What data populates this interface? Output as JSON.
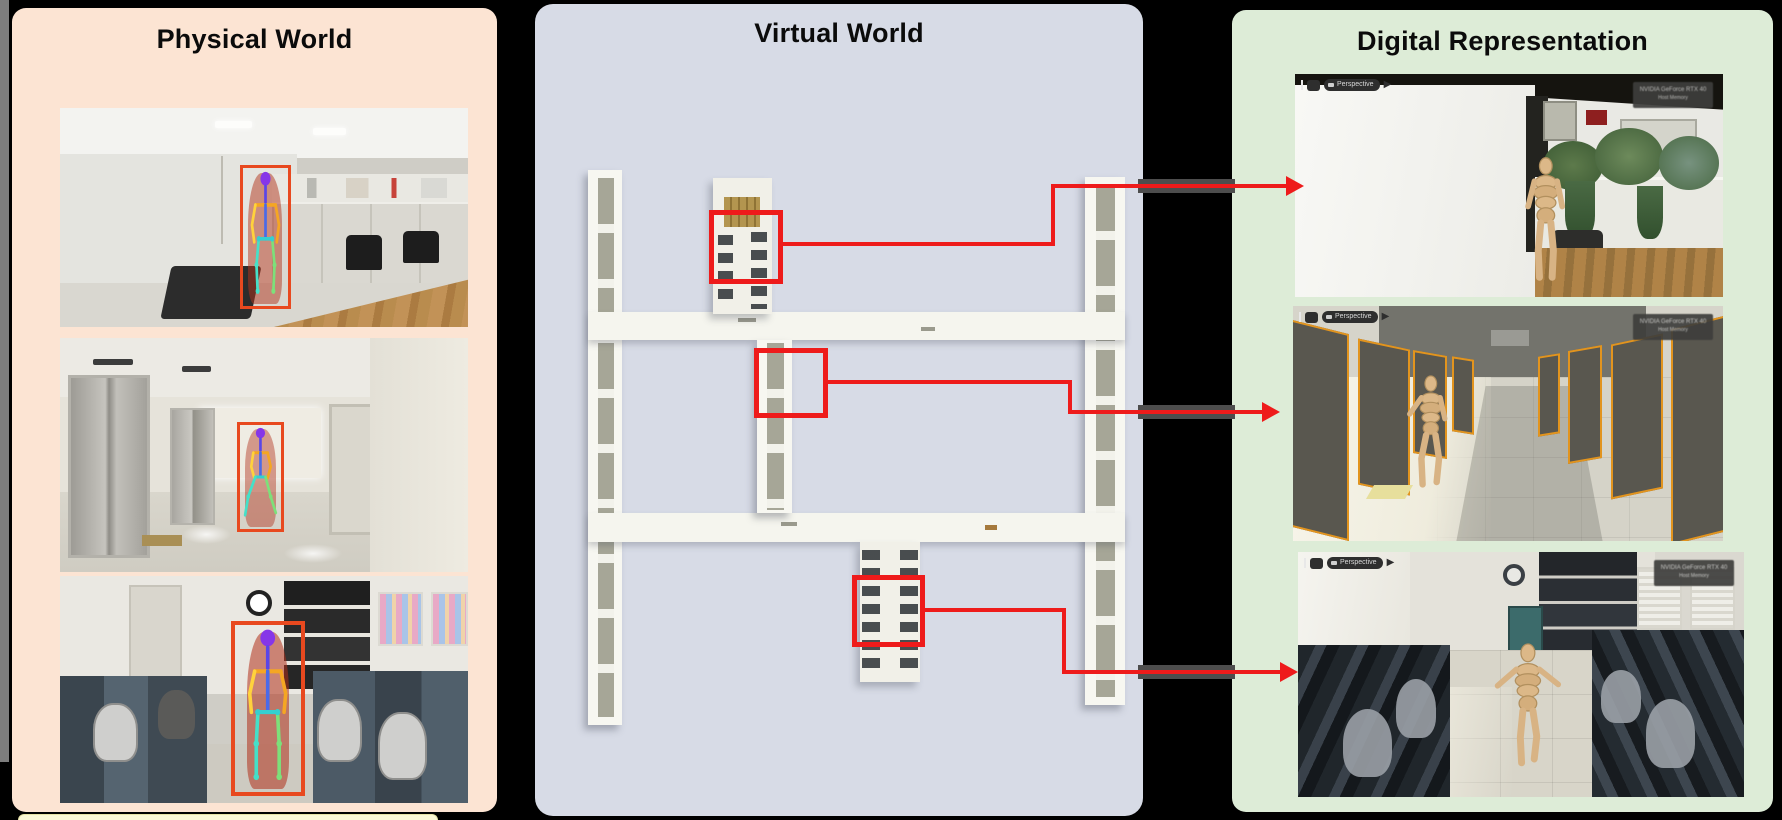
{
  "panels": {
    "physical": {
      "title": "Physical World",
      "photos": [
        {
          "name": "meeting-room-person-detection"
        },
        {
          "name": "elevator-lobby-person-detection"
        },
        {
          "name": "office-room-person-detection"
        }
      ]
    },
    "virtual": {
      "title": "Virtual World",
      "map_regions": [
        {
          "name": "top-office-region"
        },
        {
          "name": "corridor-region"
        },
        {
          "name": "bottom-office-region"
        }
      ]
    },
    "digital": {
      "title": "Digital Representation",
      "views": [
        {
          "toolbar_label": "Perspective",
          "watermark_line1": "NVIDIA GeForce RTX 40",
          "watermark_line2": "Host Memory"
        },
        {
          "toolbar_label": "Perspective",
          "watermark_line1": "NVIDIA GeForce RTX 40",
          "watermark_line2": "Host Memory"
        },
        {
          "toolbar_label": "Perspective",
          "watermark_line1": "NVIDIA GeForce RTX 40",
          "watermark_line2": "Host Memory"
        }
      ]
    }
  },
  "colors": {
    "accent_red": "#ee1b1b",
    "detection_box": "#e8491f",
    "physical_bg": "#fce4d3",
    "virtual_bg": "#d7dbe6",
    "digital_bg": "#ddecd7",
    "door_outline_orange": "#e2941e"
  }
}
